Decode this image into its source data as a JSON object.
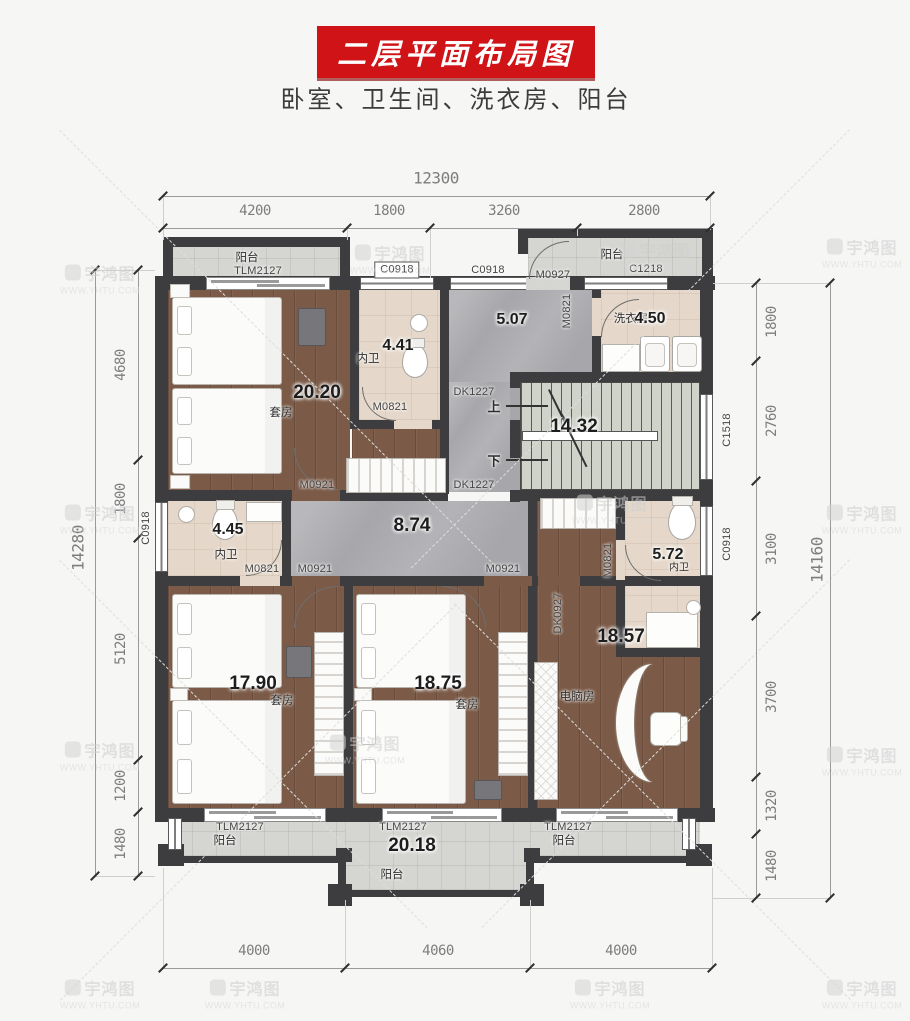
{
  "title": "二层平面布局图",
  "subtitle": "卧室、卫生间、洗衣房、阳台",
  "watermark": {
    "brand": "宇鸿图",
    "url": "WWW.YHTU.COM"
  },
  "dims": {
    "top_total": "12300",
    "top_segments": [
      "4200",
      "1800",
      "3260",
      "2800"
    ],
    "bottom_segments": [
      "4000",
      "4060",
      "4000"
    ],
    "left_total": "14280",
    "left_segments": [
      "4680",
      "1800",
      "5120",
      "1200",
      "1480"
    ],
    "right_total": "14160",
    "right_segments": [
      "1800",
      "2760",
      "3100",
      "3700",
      "1320",
      "1480"
    ]
  },
  "rooms": {
    "suite_top": {
      "area": "20.20",
      "label": "套房"
    },
    "bath_top": {
      "area": "4.41",
      "label": "内卫"
    },
    "hall_top": {
      "area": "5.07"
    },
    "laundry": {
      "area": "4.50",
      "label": "洗衣房"
    },
    "stairs": {
      "area": "14.32",
      "up": "上",
      "down": "下"
    },
    "bath_left": {
      "area": "4.45",
      "label": "内卫"
    },
    "corridor": {
      "area": "8.74"
    },
    "bath_right": {
      "area": "5.72",
      "label": "内卫"
    },
    "suite_bl": {
      "area": "17.90",
      "label": "套房"
    },
    "suite_bm": {
      "area": "18.75",
      "label": "套房"
    },
    "computer": {
      "area": "18.57",
      "label": "电脑房"
    },
    "balcony": {
      "label": "阳台",
      "area_bottom": "20.18"
    }
  },
  "codes": {
    "C0918": "C0918",
    "C1218": "C1218",
    "C1518": "C1518",
    "M0927": "M0927",
    "M0821": "M0821",
    "M0921": "M0921",
    "DK1227": "DK1227",
    "DK0927": "DK0927",
    "TLM2127": "TLM2127"
  }
}
